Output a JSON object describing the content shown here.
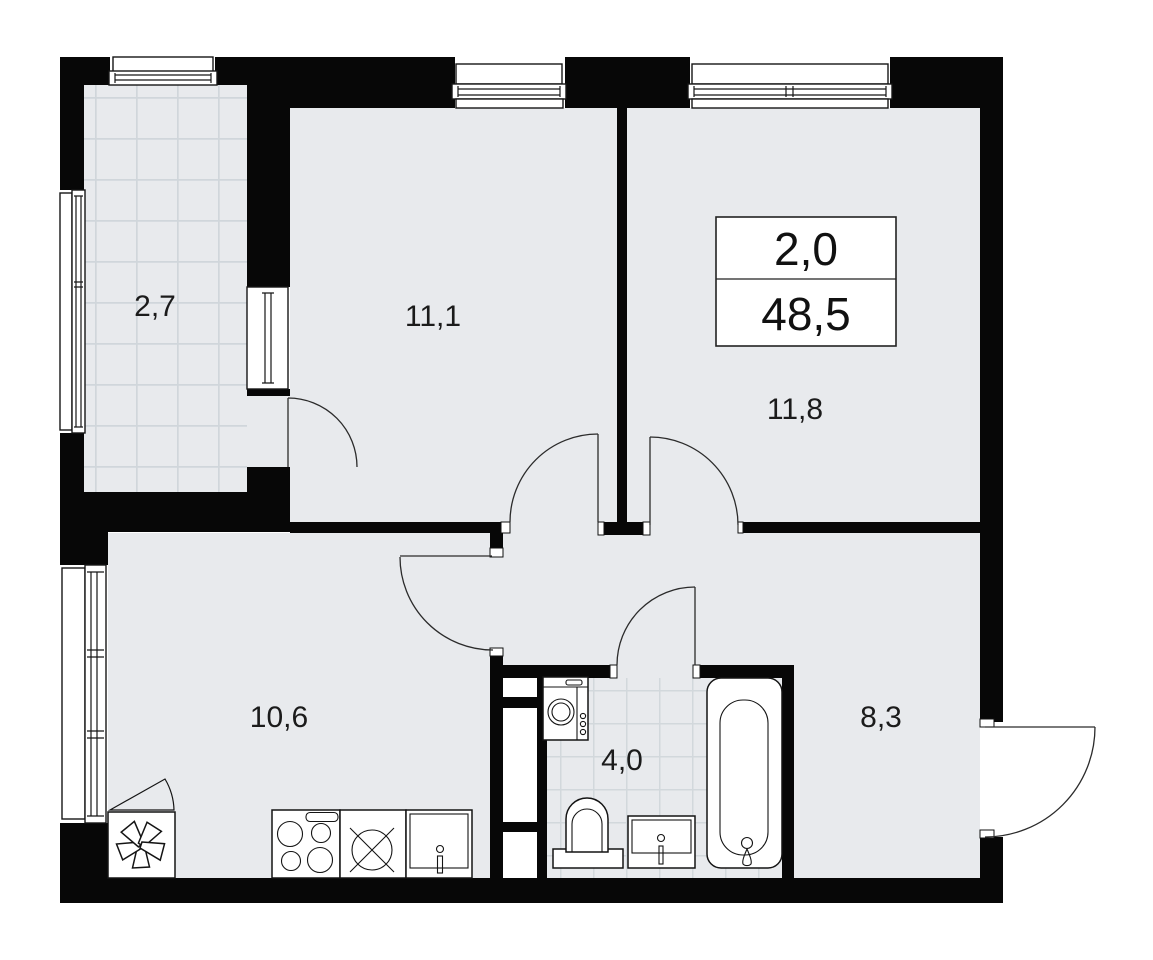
{
  "plan": {
    "info_box": {
      "rooms_count": "2,0",
      "total_area": "48,5"
    },
    "rooms": {
      "balcony": {
        "area": "2,7"
      },
      "bedroom": {
        "area": "11,1"
      },
      "living": {
        "area": "11,8"
      },
      "kitchen": {
        "area": "10,6"
      },
      "bathroom": {
        "area": "4,0"
      },
      "hallway": {
        "area": "8,3"
      }
    }
  }
}
